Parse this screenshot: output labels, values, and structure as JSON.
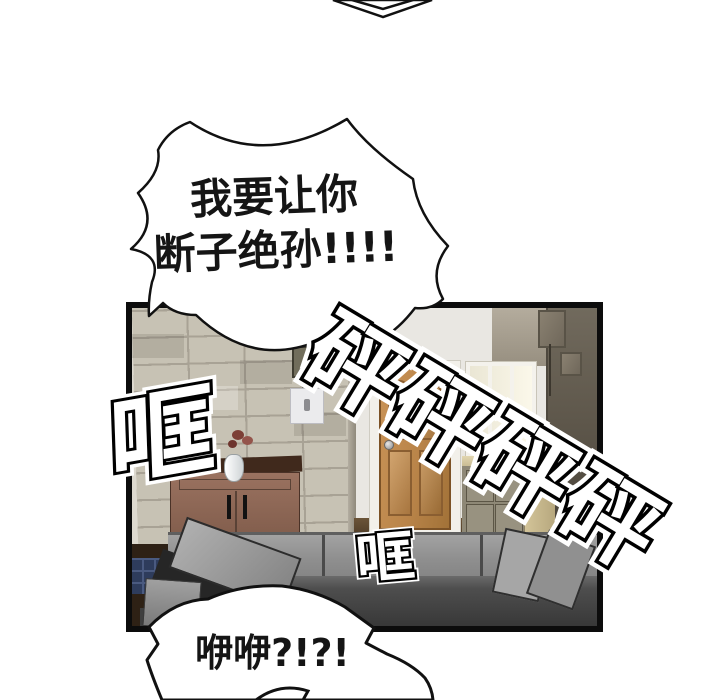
{
  "comic": {
    "top_bubble": {
      "line1": "我要让你",
      "line2": "断子绝孙!!!!"
    },
    "bottom_bubble": {
      "text": "咿咿?!?!"
    },
    "sfx": {
      "bang": "砰砰砰砰",
      "clang_left": "哐",
      "clang_mid": "哐"
    }
  },
  "palette": {
    "background": "#ffffff",
    "ink": "#111111",
    "panel_border": "#0c0c0c",
    "tile_wall": "#c7c2b4",
    "tile_grout": "#a8a295",
    "hallway_wall": "#e9e7e2",
    "door_wood": "#b98449",
    "window_glass": "#f6f2e2",
    "dark_speaker_wall": "#5e574b",
    "sideboard_wood": "#8a6352",
    "counter_wood": "#cdbd92",
    "sofa_gray": "#8f8f8f",
    "sofa_dark": "#3f3f3f",
    "floor_wood": "#4a3524",
    "blue_tile": "#2e3c5c",
    "flower": "#7c3f36"
  }
}
